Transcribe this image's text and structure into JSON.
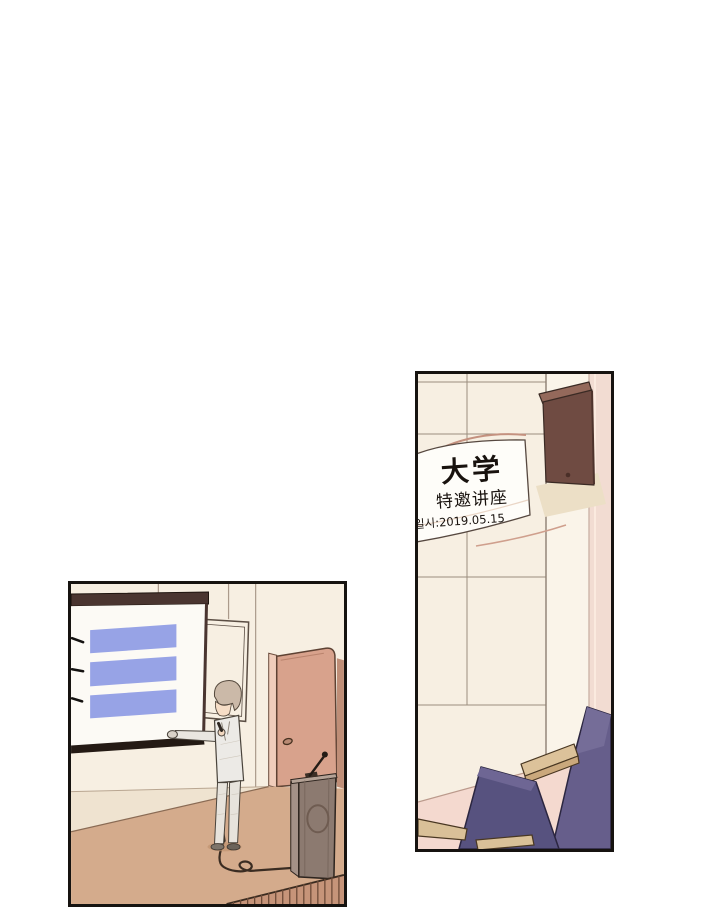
{
  "page": {
    "width": 720,
    "height": 912,
    "background": "#ffffff"
  },
  "palette": {
    "panel_border": "#161310",
    "wall_cream": "#f7efe2",
    "wall_pillar_pink": "#f2dcd2",
    "wainscot_pink": "#f4d9cf",
    "speaker_brown": "#6f4b42",
    "chair_purple": "#57527f",
    "chair_purple_light": "#6e6694",
    "wood_tan": "#d9c098",
    "screen_white": "#fcfaf5",
    "slide_blue": "#97a3e6",
    "screen_frame_brown": "#4a3530",
    "door_salmon": "#d8a28c",
    "floor_tan": "#d4ab8c",
    "suit_gray": "#eceae6",
    "podium_brown": "#8c7a70",
    "banner_white": "#fefdf9",
    "banner_text": "#18120e"
  },
  "panel_wall": {
    "label": "lecture hall wall",
    "banner": {
      "line1": "大学",
      "line2": "特邀讲座",
      "line3": "일시:2019.05.15"
    },
    "chair_count": 2
  },
  "panel_stage": {
    "label": "presentation stage",
    "slide_bar_count": 3
  }
}
